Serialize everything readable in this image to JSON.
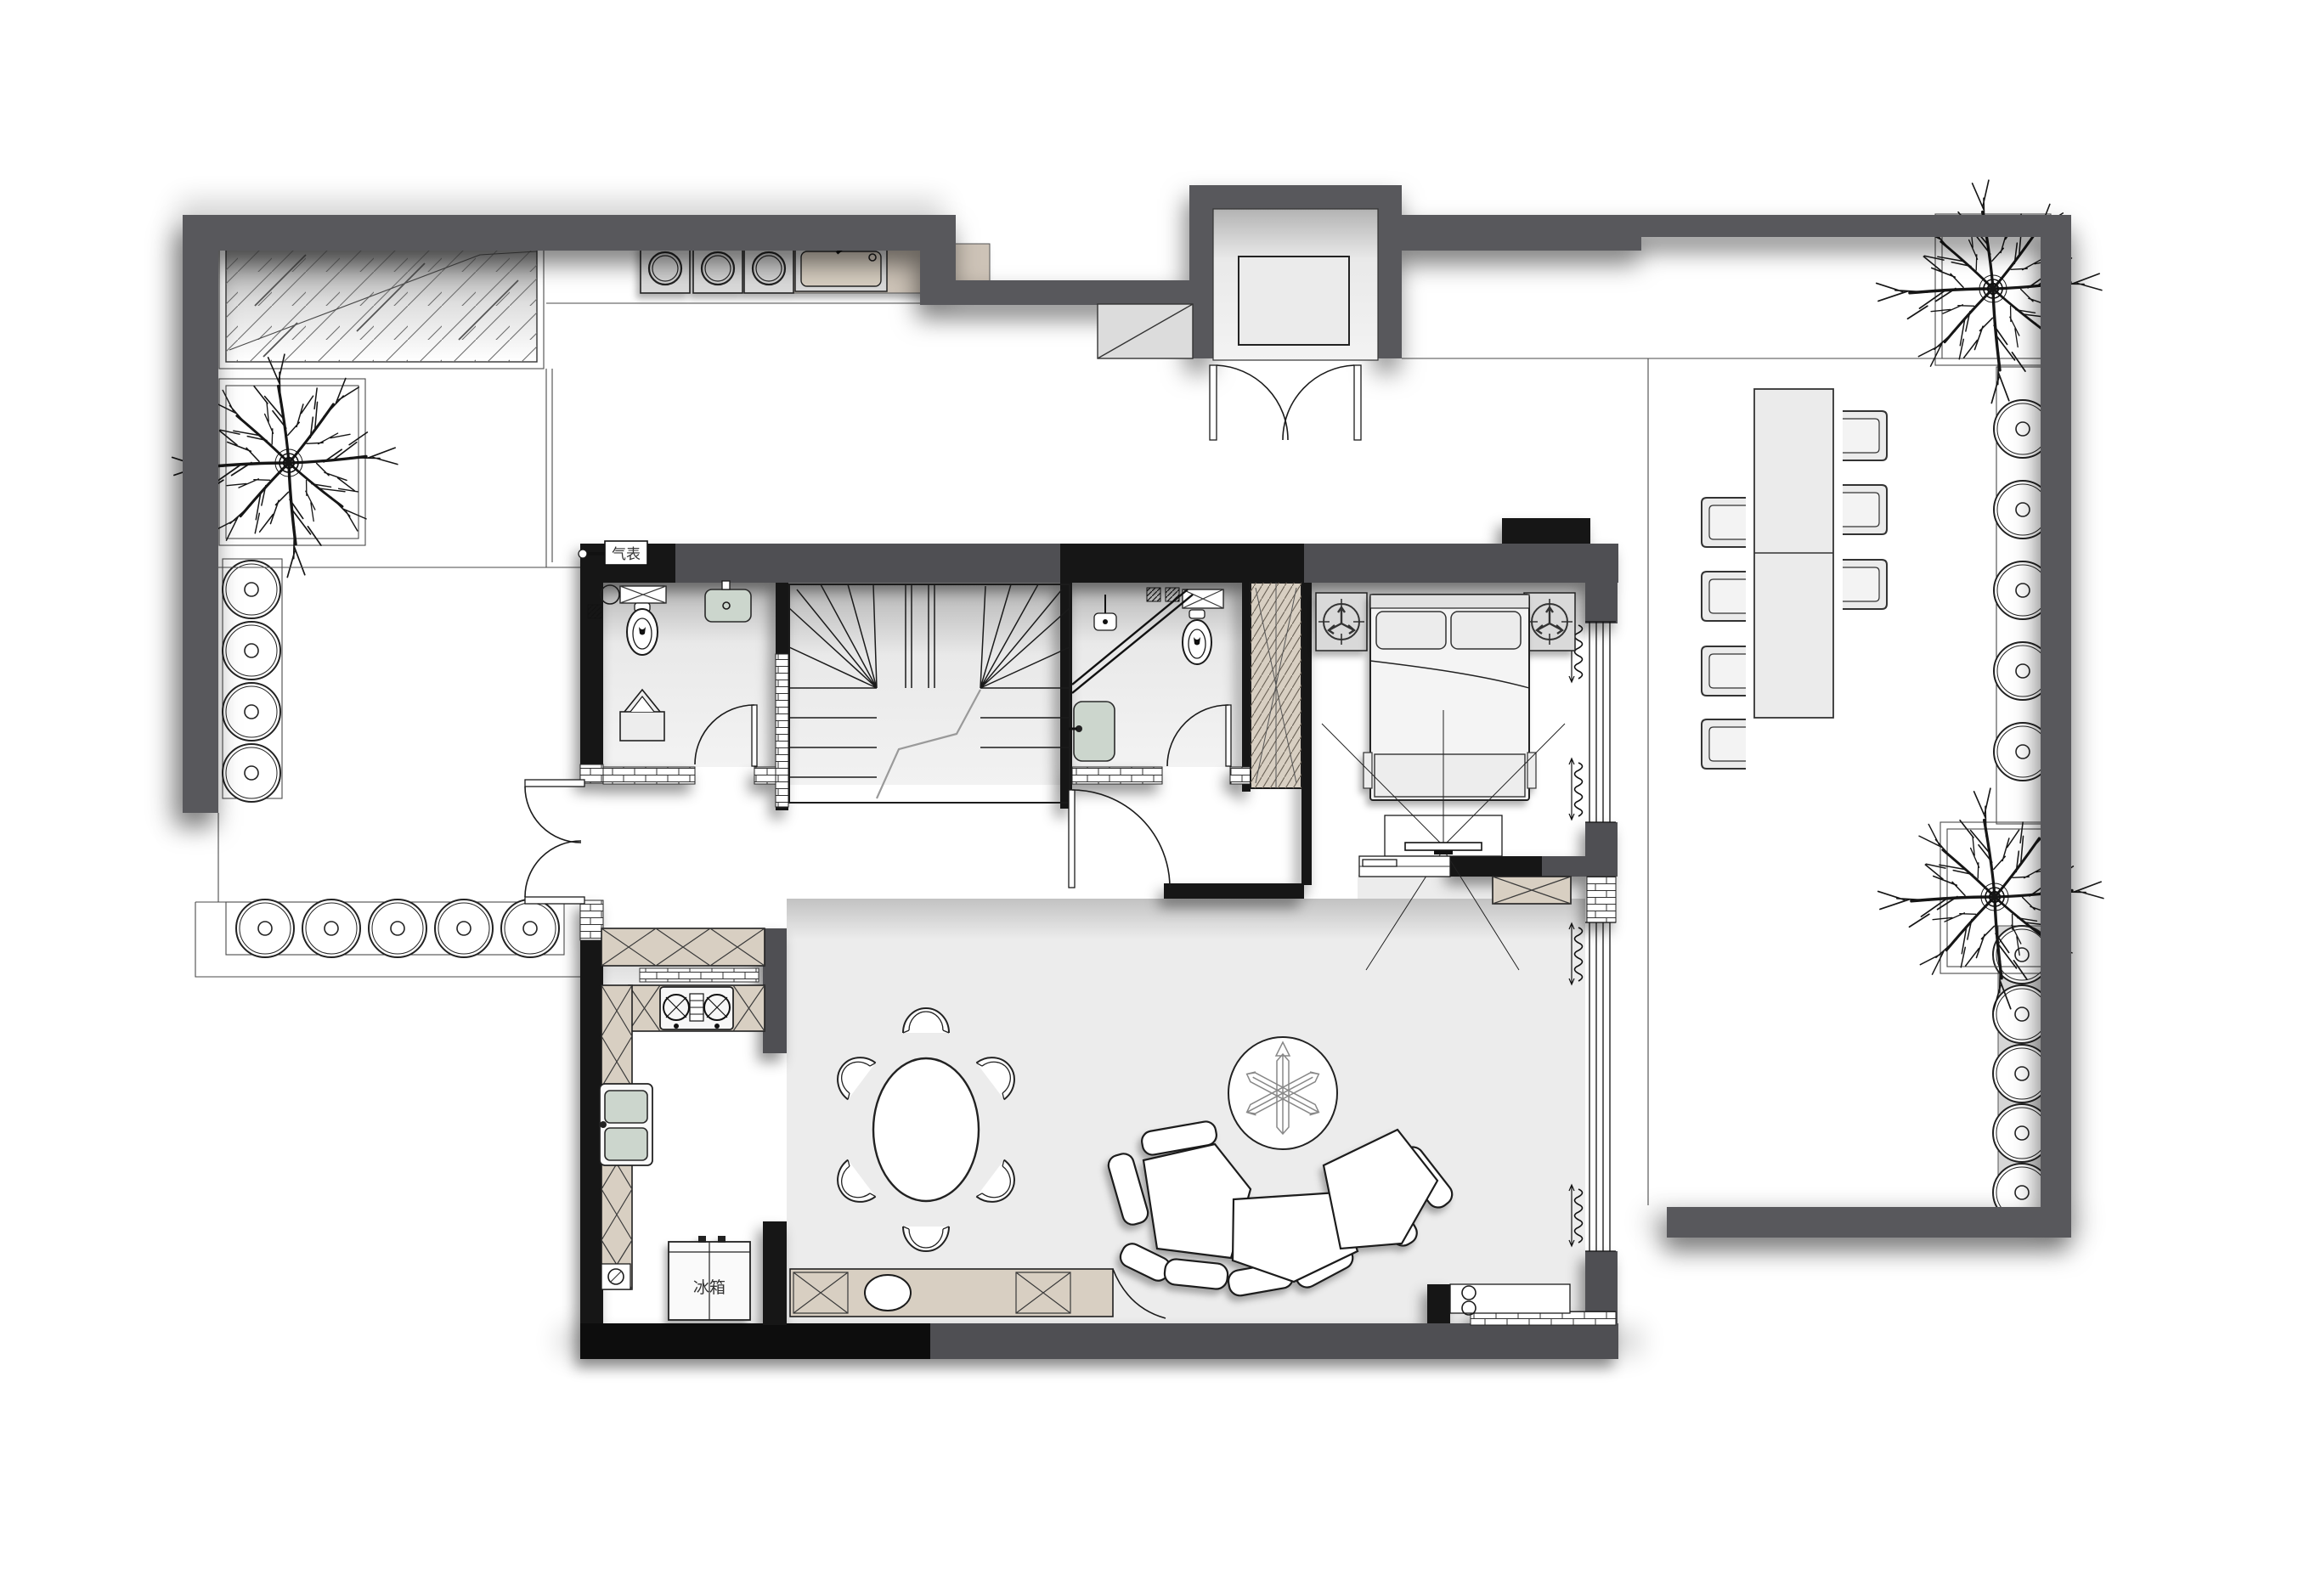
{
  "labels": {
    "gas_meter": "气表",
    "refrigerator": "冰箱"
  },
  "colors": {
    "paper": "#ffffff",
    "site_wall": "#58595b",
    "interior_wall_black": "#141414",
    "interior_wall_gray": "#4f5052",
    "cabinet_beige": "#d8cfc2",
    "fixture_green": "#ccd6cd",
    "appliance_gray": "#d9d9d9",
    "floor_living": "#ececec",
    "brick_line": "#333333",
    "plant_symbol_gray": "#888888",
    "shadow": "rgba(0,0,0,0.45)"
  },
  "inventory": {
    "trees": 3,
    "planter_pots_left_column": 4,
    "planter_pots_left_row": 5,
    "planter_pots_right_upper": 5,
    "planter_pots_right_lower": 5,
    "washing_machines": 3,
    "laundry_sinks": 1,
    "dining_chairs_indoor": 6,
    "outdoor_chairs": 7,
    "outdoor_table_sections": 2,
    "sofa_seat_modules": 3,
    "sofa_back_cushions": 8,
    "bathrooms": 2,
    "toilets": 2,
    "bathtubs": 1,
    "showers": 1,
    "beds": 1,
    "nightstands": 2,
    "tv_units": 1,
    "refrigerators": 1,
    "gas_stove_burners": 2,
    "entry_double_doors": 2
  }
}
